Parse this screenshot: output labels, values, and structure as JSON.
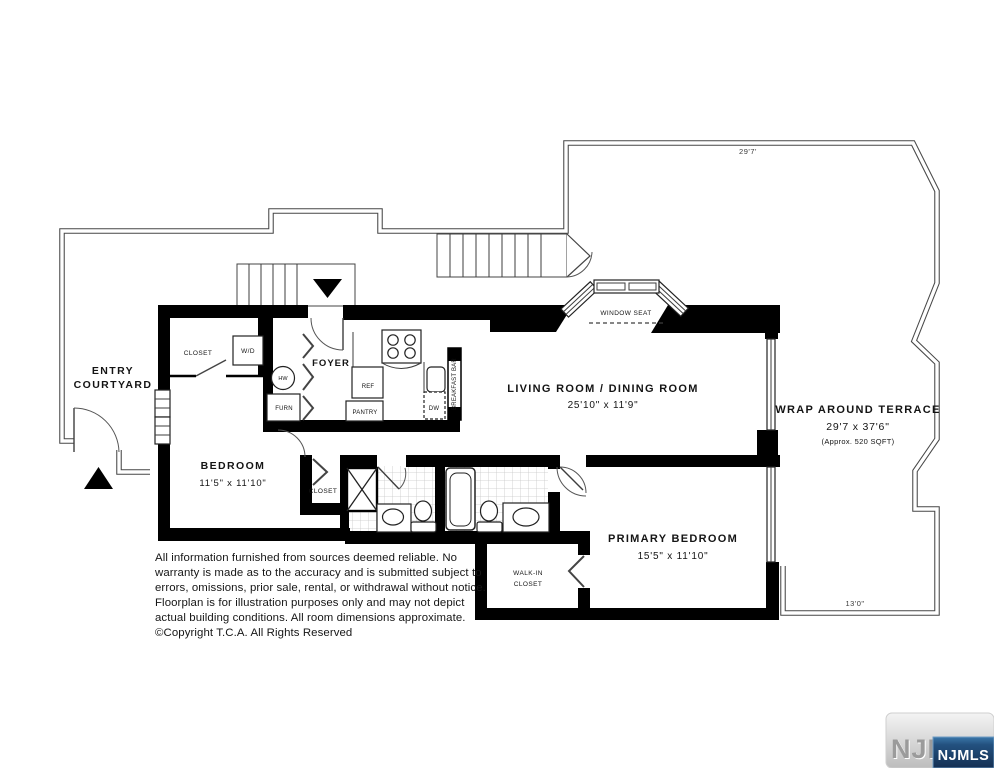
{
  "rooms": {
    "entry_courtyard": {
      "line1": "ENTRY",
      "line2": "COURTYARD"
    },
    "bedroom": {
      "name": "BEDROOM",
      "dims": "11'5\" x 11'10\""
    },
    "foyer": {
      "name": "FOYER"
    },
    "bedroom_closet": {
      "name": "CLOSET"
    },
    "hall_closet": {
      "name": "CLOSET"
    },
    "walk_in_closet": {
      "line1": "WALK-IN",
      "line2": "CLOSET"
    },
    "living_dining": {
      "name": "LIVING ROOM / DINING ROOM",
      "dims": "25'10\" x 11'9\""
    },
    "primary_bedroom": {
      "name": "PRIMARY BEDROOM",
      "dims": "15'5\" x 11'10\""
    },
    "terrace": {
      "name": "WRAP AROUND TERRACE",
      "dims": "29'7 x 37'6\"",
      "area": "(Approx. 520 SQFT)"
    },
    "window_seat": {
      "name": "WINDOW SEAT"
    }
  },
  "fixtures": {
    "wd": "W/D",
    "hw": "HW",
    "furn": "FURN",
    "ref": "REF",
    "pantry": "PANTRY",
    "dw": "DW",
    "breakfast_bar": "BREAKFAST BAR"
  },
  "dimensions": {
    "terrace_top": "29'7'",
    "terrace_bottom": "13'0\""
  },
  "disclaimer": {
    "lines": [
      "All information furnished from sources deemed reliable. No",
      "warranty is made as to the accuracy and is submitted subject to",
      "errors, omissions, prior sale, rental, or withdrawal without notice.",
      "Floorplan is for illustration purposes only and may not depict",
      "actual building conditions. All room dimensions approximate.",
      "©Copyright T.C.A. All Rights Reserved"
    ]
  },
  "branding": {
    "watermark": "NJMLS",
    "badge": "NJMLS"
  },
  "colors": {
    "wall": "#000000",
    "outline": "#474747",
    "badge_blue_top": "#356f9f",
    "badge_blue_bottom": "#16365e",
    "badge_text": "#ffffff",
    "watermark_gray": "#9b9b9b"
  }
}
